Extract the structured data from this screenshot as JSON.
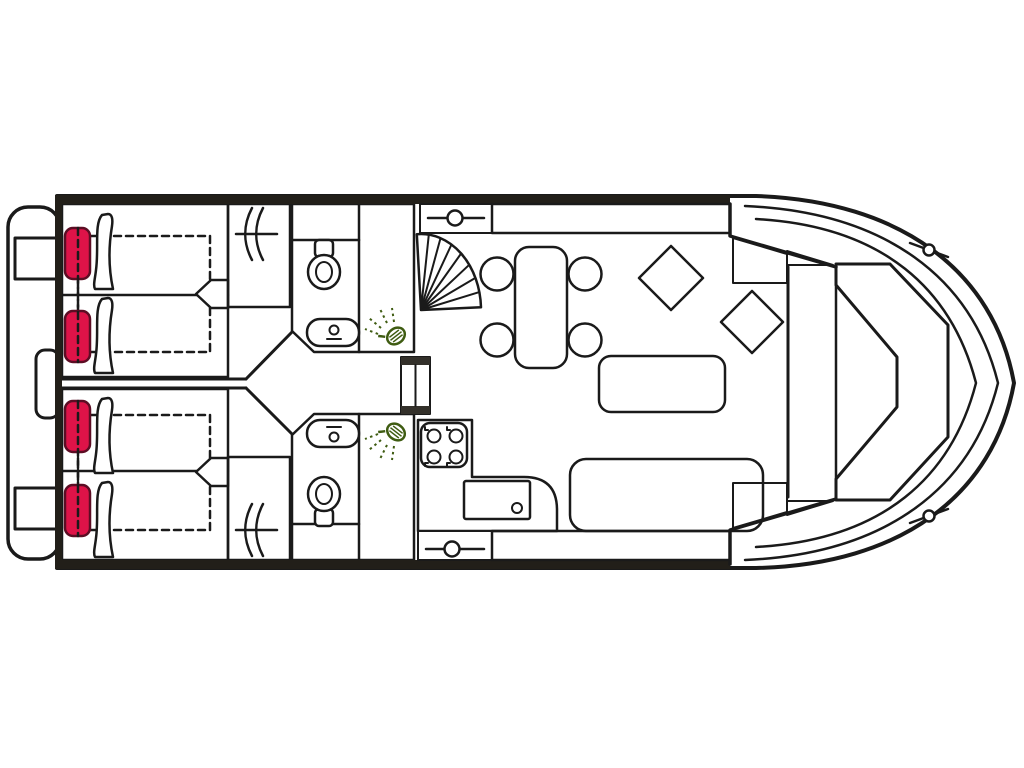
{
  "meta": {
    "title": "Houseboat deck floor plan",
    "view": "top-down plan, bow to the right, stern platform to the left",
    "canvas": {
      "width": 1024,
      "height": 768
    }
  },
  "colors": {
    "outline": "#1a1a1a",
    "wall_dark": "#221f19",
    "hull_white": "#ffffff",
    "bed_light": "#f6d7cc",
    "bed_mid": "#ec4a63",
    "bed_deep": "#e60d44",
    "cushion": "#de1348",
    "cushion_border": "#5c0d24",
    "wood_light": "#e0a02e",
    "wood_dark": "#b87818",
    "green_light": "#a9cb61",
    "green_dark": "#92ba45",
    "blue_light": "#36abdf",
    "blue_dark": "#0a7ec0",
    "yellow": "#ffdf00",
    "counter_grey": "#b3a79d",
    "cabinet_cap": "#33302a",
    "shower_green": "#3f5c12"
  },
  "legend": {
    "stern_platform": "swim platform with boarding steps and ladder",
    "aft_cabins": "two aft cabins, each with twin berths, headrest cushions and pillows",
    "wardrobes": "two hanging lockers with clothes-rail symbol",
    "bathrooms": "two bathrooms, each with toilet, washbasin and shower",
    "corridor": "central companionway between cabins and bathrooms",
    "fridge_cabinet": "cabinet between bathrooms",
    "spiral_staircase": "fan-shaped companionway steps to saloon",
    "galley": "L-shaped counter with 4-burner stove and sink",
    "side_doors": "port and starboard deck doors",
    "storage_lockers": "port and starboard storage cabinets",
    "dinette": "table with four chairs",
    "stools": "two diamond stools",
    "sofas": "small sofa and long sofa",
    "bow_seat": "wrap-around bow bench",
    "cleats": "port and starboard mooring cleats"
  }
}
